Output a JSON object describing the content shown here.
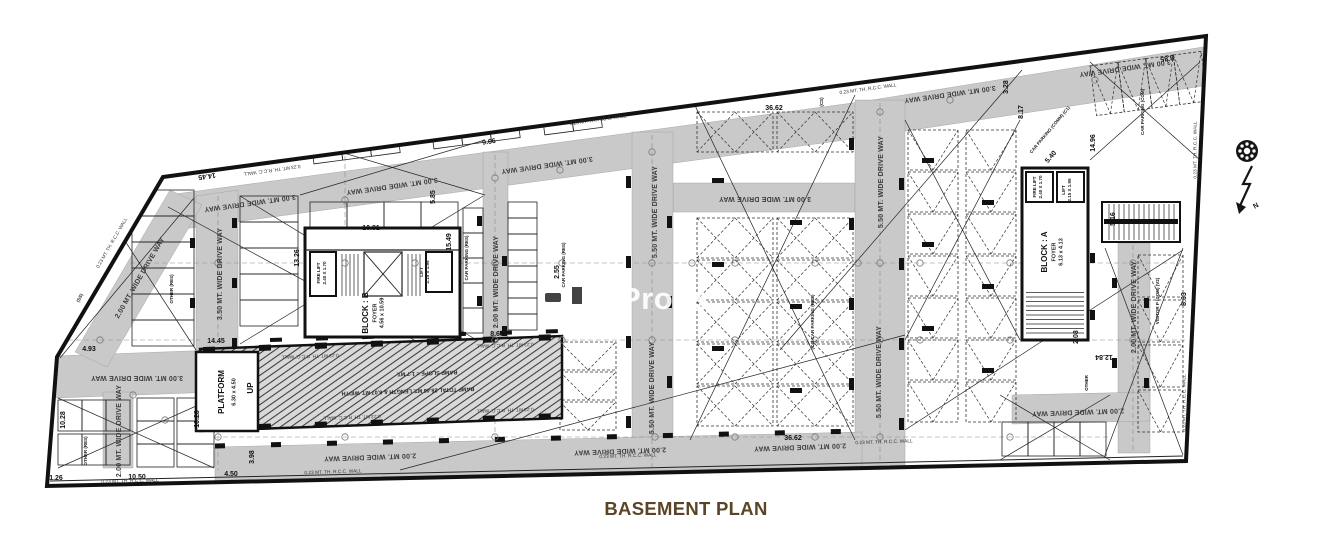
{
  "title": "BASEMENT PLAN",
  "watermark": "Props",
  "compass": {
    "label": "N"
  },
  "colors": {
    "page": "#ffffff",
    "plan_fill": "#ffffff",
    "driveway_gray": "#c9c9c9",
    "line_black": "#111111",
    "title_brown": "#5a4527",
    "watermark_white": "#ffffff"
  },
  "plan": {
    "labels": [
      {
        "t": "14.45",
        "x": 207,
        "y": 176,
        "r": 172,
        "c": "dim"
      },
      {
        "t": "14.45",
        "x": 216,
        "y": 341,
        "r": 0,
        "c": "dim"
      },
      {
        "t": "4.93",
        "x": 89,
        "y": 349,
        "r": 0,
        "c": "dim"
      },
      {
        "t": "1.26",
        "x": 56,
        "y": 478,
        "r": 0,
        "c": "dim",
        "s": 6
      },
      {
        "t": "10.28",
        "x": 63,
        "y": 420,
        "r": -90,
        "c": "dim",
        "s": 6.5
      },
      {
        "t": "10.28",
        "x": 197,
        "y": 419,
        "r": -90,
        "c": "dim",
        "s": 6.5
      },
      {
        "t": "10.50",
        "x": 137,
        "y": 477,
        "r": 0,
        "c": "dim"
      },
      {
        "t": "4.50",
        "x": 231,
        "y": 474,
        "r": 0,
        "c": "dim"
      },
      {
        "t": "3.98",
        "x": 252,
        "y": 457,
        "r": -90,
        "c": "dim",
        "s": 6
      },
      {
        "t": "13.26",
        "x": 297,
        "y": 258,
        "r": -90,
        "c": "dim"
      },
      {
        "t": "10.81",
        "x": 371,
        "y": 228,
        "r": 0,
        "c": "dim"
      },
      {
        "t": "15.49",
        "x": 449,
        "y": 242,
        "r": -90,
        "c": "dim"
      },
      {
        "t": "5.85",
        "x": 433,
        "y": 197,
        "r": -90,
        "c": "dim",
        "s": 6.5
      },
      {
        "t": "9.66",
        "x": 489,
        "y": 142,
        "r": -8,
        "c": "dim"
      },
      {
        "t": "8.66",
        "x": 497,
        "y": 334,
        "r": 0,
        "c": "dim"
      },
      {
        "t": "2.55",
        "x": 557,
        "y": 272,
        "r": -90,
        "c": "dim",
        "s": 6
      },
      {
        "t": "36.62",
        "x": 774,
        "y": 108,
        "r": 0,
        "c": "dim"
      },
      {
        "t": "36.62",
        "x": 793,
        "y": 438,
        "r": 0,
        "c": "dim"
      },
      {
        "t": "8.17",
        "x": 1021,
        "y": 112,
        "r": -90,
        "c": "dim"
      },
      {
        "t": "3.28",
        "x": 1006,
        "y": 87,
        "r": -90,
        "c": "dim",
        "s": 6
      },
      {
        "t": "5.40",
        "x": 1051,
        "y": 157,
        "r": -50,
        "c": "dim",
        "s": 6
      },
      {
        "t": "14.96",
        "x": 1093,
        "y": 143,
        "r": -90,
        "c": "dim"
      },
      {
        "t": "8.85",
        "x": 1167,
        "y": 58,
        "r": 172,
        "c": "dim"
      },
      {
        "t": "8.63",
        "x": 1184,
        "y": 299,
        "r": -90,
        "c": "dim"
      },
      {
        "t": "12.84",
        "x": 1104,
        "y": 357,
        "r": 180,
        "c": "dim",
        "s": 6.5
      },
      {
        "t": "5.16",
        "x": 1113,
        "y": 219,
        "r": -90,
        "c": "dim",
        "s": 5.5
      },
      {
        "t": "2.08",
        "x": 1076,
        "y": 337,
        "r": -90,
        "c": "dim",
        "s": 5.5
      },
      {
        "t": "0.23 MT. TH. R.C.C. WALL",
        "x": 272,
        "y": 170,
        "r": 172,
        "c": "wall"
      },
      {
        "t": "0.23 MT. TH. R.C.C. WALL",
        "x": 598,
        "y": 120,
        "r": -8,
        "c": "wall"
      },
      {
        "t": "0.23 MT. TH. R.C.C. WALL",
        "x": 868,
        "y": 89,
        "r": -8,
        "c": "wall"
      },
      {
        "t": "0.23 MT. TH. R.C.C. WALL",
        "x": 1195,
        "y": 150,
        "r": -90,
        "c": "wall"
      },
      {
        "t": "0.23 MT. TH. R.C.C. WALL",
        "x": 112,
        "y": 243,
        "r": -60,
        "c": "wall"
      },
      {
        "t": "0.23 MT. TH. R.C.C. WALL",
        "x": 130,
        "y": 481,
        "r": -2,
        "c": "wall"
      },
      {
        "t": "0.23 MT. TH. R.C.C. WALL",
        "x": 333,
        "y": 472,
        "r": -2,
        "c": "wall"
      },
      {
        "t": "0.23 MT. TH. R.C.C. WALL",
        "x": 628,
        "y": 456,
        "r": -2,
        "c": "wall"
      },
      {
        "t": "0.23 MT. TH. R.C.C. WALL",
        "x": 884,
        "y": 442,
        "r": -2,
        "c": "wall"
      },
      {
        "t": "0.23 MT. TH. R.C.C. WALL",
        "x": 1184,
        "y": 403,
        "r": -90,
        "c": "wall"
      },
      {
        "t": "0.23 MT. TH. R.C.C. WALL",
        "x": 310,
        "y": 356,
        "r": 178,
        "c": "wall"
      },
      {
        "t": "0.23 MT. TH. R.C.C. WALL",
        "x": 505,
        "y": 345,
        "r": 178,
        "c": "wall"
      },
      {
        "t": "0.23 MT. TH. R.C.C. WALL",
        "x": 352,
        "y": 417,
        "r": 178,
        "c": "wall"
      },
      {
        "t": "0.23 MT. TH. R.C.C. WALL",
        "x": 505,
        "y": 410,
        "r": 178,
        "c": "wall"
      },
      {
        "t": "3.50 MT. WIDE DRIVE WAY",
        "x": 220,
        "y": 274,
        "r": -90,
        "c": "band"
      },
      {
        "t": "2.00 MT. WIDE DRIVE WAY",
        "x": 140,
        "y": 278,
        "r": -60,
        "c": "band"
      },
      {
        "t": "3.00 MT. WIDE DRIVE WAY",
        "x": 137,
        "y": 378,
        "r": 180,
        "c": "band",
        "s": 6
      },
      {
        "t": "2.00 MT. WIDE DRIVE WAY",
        "x": 119,
        "y": 431,
        "r": -90,
        "c": "band",
        "s": 4.5
      },
      {
        "t": "3.00 MT. WIDE DRIVE WAY",
        "x": 250,
        "y": 203,
        "r": 172,
        "c": "band",
        "s": 6
      },
      {
        "t": "3.00 MT. WIDE DRIVE WAY",
        "x": 392,
        "y": 186,
        "r": 172,
        "c": "band",
        "s": 6.5
      },
      {
        "t": "3.00 MT. WIDE DRIVE WAY",
        "x": 547,
        "y": 165,
        "r": 172,
        "c": "band",
        "s": 6.5
      },
      {
        "t": "3.00 MT. WIDE DRIVE WAY",
        "x": 765,
        "y": 199,
        "r": 180,
        "c": "band",
        "s": 6.5
      },
      {
        "t": "3.00 MT. WIDE DRIVE WAY",
        "x": 950,
        "y": 94,
        "r": 172,
        "c": "band",
        "s": 6.5
      },
      {
        "t": "3.00 MT. WIDE DRIVE WAY",
        "x": 1125,
        "y": 68,
        "r": 172,
        "c": "band",
        "s": 6.5
      },
      {
        "t": "2.00 MT. WIDE DRIVE WAY",
        "x": 496,
        "y": 282,
        "r": -90,
        "c": "band",
        "s": 6
      },
      {
        "t": "5.50 MT. WIDE DRIVE WAY",
        "x": 655,
        "y": 212,
        "r": -90,
        "c": "band"
      },
      {
        "t": "5.50 MT. WIDE DRIVE WAY",
        "x": 652,
        "y": 388,
        "r": -90,
        "c": "band"
      },
      {
        "t": "5.50 MT. WIDE DRIVE WAY",
        "x": 881,
        "y": 182,
        "r": -90,
        "c": "band"
      },
      {
        "t": "5.50 MT. WIDE DRIVE WAY",
        "x": 879,
        "y": 372,
        "r": -90,
        "c": "band"
      },
      {
        "t": "2.00 MT. WIDE DRIVE WAY",
        "x": 1134,
        "y": 307,
        "r": -90,
        "c": "band",
        "s": 6
      },
      {
        "t": "2.00 MT. WIDE DRIVE WAY",
        "x": 370,
        "y": 457,
        "r": 178,
        "c": "band",
        "s": 6.5
      },
      {
        "t": "2.00 MT. WIDE DRIVE WAY",
        "x": 620,
        "y": 451,
        "r": 178,
        "c": "band",
        "s": 6.5
      },
      {
        "t": "2.00 MT. WIDE DRIVE WAY",
        "x": 800,
        "y": 447,
        "r": 178,
        "c": "band",
        "s": 6.5
      },
      {
        "t": "2.00 MT. WIDE DRIVE WAY",
        "x": 1078,
        "y": 412,
        "r": 178,
        "c": "band",
        "s": 5
      },
      {
        "t": "BLOCK : B",
        "x": 366,
        "y": 313,
        "r": -90,
        "c": "room"
      },
      {
        "t": "FOYER",
        "x": 375,
        "y": 313,
        "r": -90,
        "c": "sub"
      },
      {
        "t": "4.56 x 10.59",
        "x": 382,
        "y": 313,
        "r": -90,
        "c": "sub",
        "s": 5
      },
      {
        "t": "BLOCK : A",
        "x": 1045,
        "y": 252,
        "r": -90,
        "c": "room"
      },
      {
        "t": "FOYER",
        "x": 1054,
        "y": 252,
        "r": -90,
        "c": "sub"
      },
      {
        "t": "6.13 x 4.13",
        "x": 1061,
        "y": 252,
        "r": -90,
        "c": "sub",
        "s": 5
      },
      {
        "t": "PLATFORM",
        "x": 222,
        "y": 392,
        "r": -90,
        "c": "room",
        "s": 7
      },
      {
        "t": "6.30 x 4.50",
        "x": 234,
        "y": 392,
        "r": -90,
        "c": "sub",
        "s": 6
      },
      {
        "t": "UP",
        "x": 251,
        "y": 388,
        "r": -90,
        "c": "room",
        "s": 7
      },
      {
        "t": "RAMP SLOPE = 1:7 MT.",
        "x": 427,
        "y": 373,
        "r": 178,
        "c": "sub",
        "s": 6.5
      },
      {
        "t": "RAMP TOTAL 28.46 MT. LENGTH & 6.07 MT. WIDTH",
        "x": 408,
        "y": 391,
        "r": 178,
        "c": "sub",
        "s": 6.5
      },
      {
        "t": "FIRE LIFT",
        "x": 319,
        "y": 273,
        "r": -90,
        "c": "tiny"
      },
      {
        "t": "2.40 X 1.70",
        "x": 325,
        "y": 273,
        "r": -90,
        "c": "tiny",
        "s": 4
      },
      {
        "t": "LIFT",
        "x": 422,
        "y": 272,
        "r": -90,
        "c": "tiny"
      },
      {
        "t": "2.15 X 1.95",
        "x": 428,
        "y": 272,
        "r": -90,
        "c": "tiny",
        "s": 4
      },
      {
        "t": "FIRE LIFT",
        "x": 1035,
        "y": 187,
        "r": -90,
        "c": "tiny"
      },
      {
        "t": "2.40 X 1.70",
        "x": 1041,
        "y": 187,
        "r": -90,
        "c": "tiny",
        "s": 4
      },
      {
        "t": "LIFT",
        "x": 1064,
        "y": 190,
        "r": -90,
        "c": "tiny"
      },
      {
        "t": "2.15 X 1.95",
        "x": 1070,
        "y": 190,
        "r": -90,
        "c": "tiny",
        "s": 4
      },
      {
        "t": "CAR PARKING (RES)",
        "x": 467,
        "y": 258,
        "r": -90,
        "c": "tiny",
        "s": 4.8
      },
      {
        "t": "CAR PARKING (RES)",
        "x": 564,
        "y": 265,
        "r": -90,
        "c": "tiny",
        "s": 4.8
      },
      {
        "t": "(C4) CAR PARKING (RES)",
        "x": 813,
        "y": 322,
        "r": -90,
        "c": "tiny",
        "s": 4.8
      },
      {
        "t": "CAR PARKING (COMM) (C1)",
        "x": 1050,
        "y": 130,
        "r": -50,
        "c": "tiny",
        "s": 4.5
      },
      {
        "t": "CAR PARKING (COM)",
        "x": 1143,
        "y": 112,
        "r": -90,
        "c": "tiny",
        "s": 4.5
      },
      {
        "t": "VISITOR P (COM) (V2)",
        "x": 1158,
        "y": 301,
        "r": -90,
        "c": "tiny",
        "s": 4.5
      },
      {
        "t": "OTHER (RES)",
        "x": 172,
        "y": 289,
        "r": -90,
        "c": "tiny",
        "s": 4.8
      },
      {
        "t": "OTHER (RES)",
        "x": 86,
        "y": 451,
        "r": -90,
        "c": "tiny",
        "s": 4.8
      },
      {
        "t": "OTHER",
        "x": 1087,
        "y": 383,
        "r": -90,
        "c": "tiny",
        "s": 4.8
      },
      {
        "t": "(SS)",
        "x": 80,
        "y": 298,
        "r": -65,
        "c": "tiny",
        "s": 5.5
      },
      {
        "t": "(CS)",
        "x": 822,
        "y": 102,
        "r": -90,
        "c": "tiny",
        "s": 5
      },
      {
        "t": "N",
        "x": 1256,
        "y": 206,
        "r": -30,
        "c": "dim",
        "s": 9
      }
    ]
  }
}
